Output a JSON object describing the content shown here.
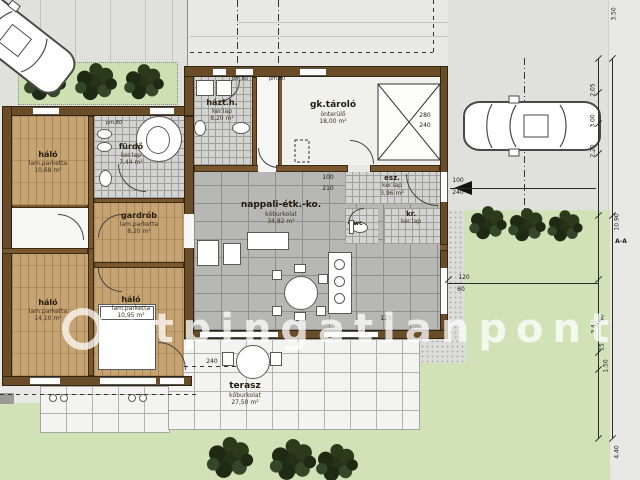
{
  "watermark": {
    "prefix": "otp",
    "rest": "ingatlanpont"
  },
  "rooms": [
    {
      "name": "háló",
      "floor": "lam.parketta",
      "area": "10,68 m²"
    },
    {
      "name": "fürdő",
      "floor": "ker.lap",
      "area": "7,44 m²"
    },
    {
      "name": "házt.h.",
      "floor": "ker.lap",
      "area": "8,20 m²"
    },
    {
      "name": "gardrób",
      "floor": "lam.parketta",
      "area": "8,20 m²"
    },
    {
      "name": "gk.tároló",
      "floor": "önterülő",
      "area": "18,00 m²"
    },
    {
      "name": "nappali-étk.-ko.",
      "floor": "kőburkolat",
      "area": "34,82 m²"
    },
    {
      "name": "esz.",
      "floor": "ker.lap",
      "area": "3,96 m²"
    },
    {
      "name": "wc",
      "floor": "",
      "area": ""
    },
    {
      "name": "kr.",
      "floor": "ker.lap",
      "area": ""
    },
    {
      "name": "háló",
      "floor": "lam.parketta",
      "area": "14,10 m²"
    },
    {
      "name": "háló",
      "floor": "lam.parketta",
      "area": "10,95 m²"
    },
    {
      "name": "terasz",
      "floor": "kőburkolat",
      "area": "27,50 m²"
    }
  ],
  "doors": {
    "pm80": "pm.80"
  },
  "dims": {
    "right": [
      "3.50",
      "2.05",
      "3.00",
      "2.20",
      "30",
      "10.90",
      "3.45",
      "15",
      "1.50",
      "4.40"
    ],
    "plot": [
      "120",
      "60"
    ],
    "terrace": "240",
    "living": "120",
    "garage": [
      "280",
      "240"
    ],
    "door_a": [
      "100",
      "210"
    ],
    "door_b": [
      "100",
      "240"
    ],
    "section": "A-A"
  },
  "colors": {
    "wall": "#6b4c28",
    "grass": "#d1e2b7",
    "wood": "#c6a372",
    "paper": "#e8e8e6"
  }
}
